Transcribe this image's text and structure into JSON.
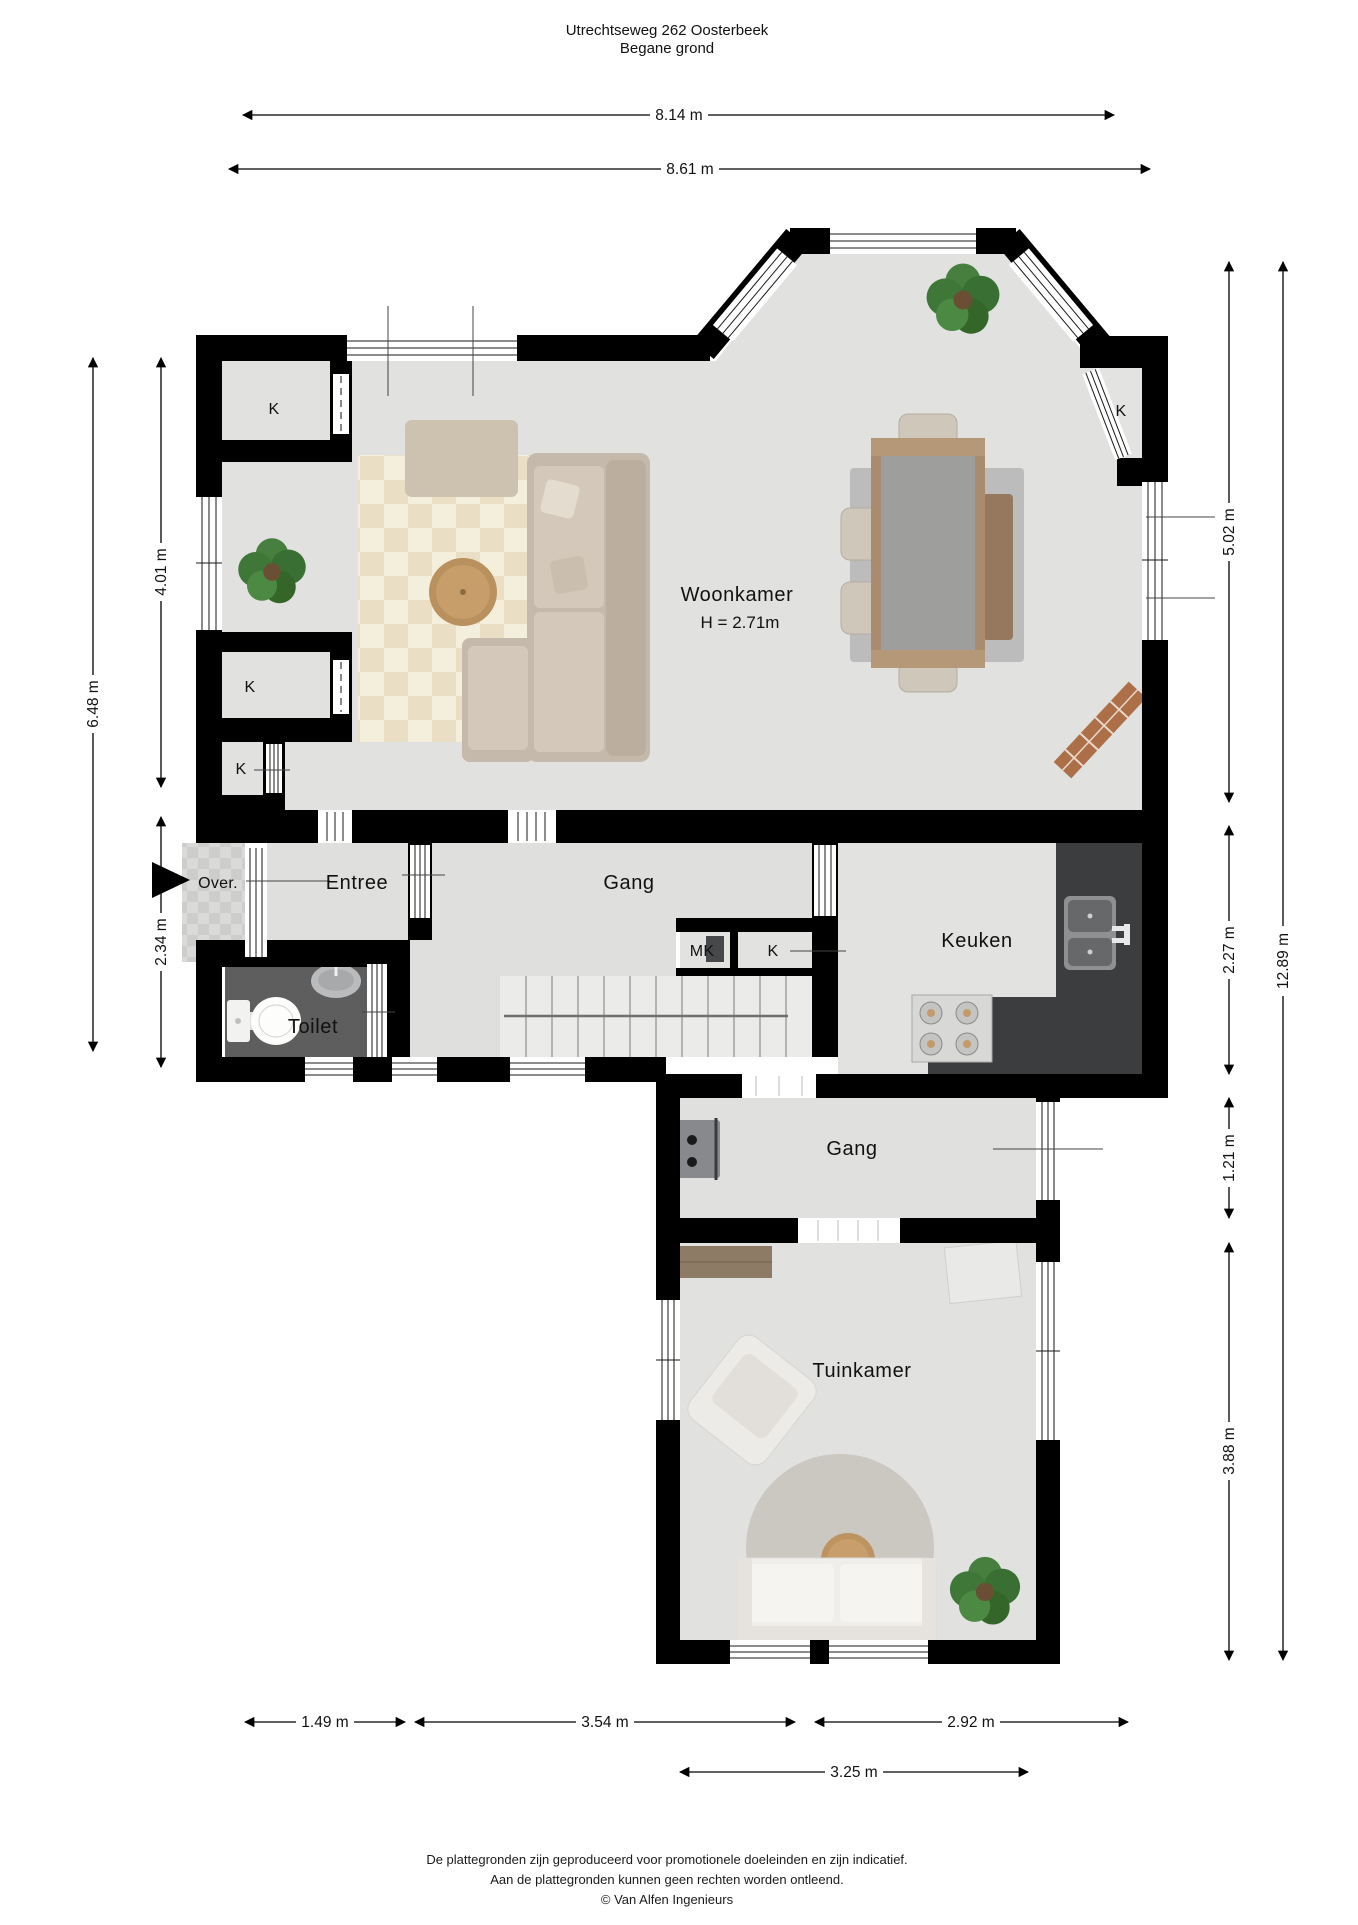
{
  "title": {
    "line1": "Utrechtseweg 262 Oosterbeek",
    "line2": "Begane grond"
  },
  "rooms": {
    "woonkamer": {
      "label": "Woonkamer",
      "height": "H = 2.71m"
    },
    "entree": {
      "label": "Entree"
    },
    "gang_boven": {
      "label": "Gang"
    },
    "gang_beneden": {
      "label": "Gang"
    },
    "keuken": {
      "label": "Keuken"
    },
    "toilet": {
      "label": "Toilet"
    },
    "tuinkamer": {
      "label": "Tuinkamer"
    },
    "overloop": {
      "label": "Over."
    },
    "meterkast": {
      "label": "MK"
    },
    "kast": {
      "label": "K"
    }
  },
  "dimensions": {
    "top": [
      {
        "value": "8.14 m"
      },
      {
        "value": "8.61 m"
      }
    ],
    "left": [
      {
        "value": "4.01 m"
      },
      {
        "value": "6.48 m"
      },
      {
        "value": "2.34 m"
      }
    ],
    "right": [
      {
        "value": "5.02 m"
      },
      {
        "value": "2.27 m"
      },
      {
        "value": "1.21 m"
      },
      {
        "value": "3.88 m"
      },
      {
        "value": "12.89 m"
      }
    ],
    "bottom": [
      {
        "value": "1.49 m"
      },
      {
        "value": "3.54 m"
      },
      {
        "value": "2.92 m"
      },
      {
        "value": "3.25 m"
      }
    ]
  },
  "footer": {
    "line1": "De plattegronden zijn geproduceerd voor promotionele doeleinden en zijn indicatief.",
    "line2": "Aan de plattegronden kunnen geen rechten worden ontleend.",
    "line3": "© Van Alfen Ingenieurs"
  },
  "colors": {
    "wall": "#000000",
    "floor": "#e1e1e0",
    "toilet_floor": "#5e5e5e",
    "kitchen_counter": "#3b3d3e",
    "rug_cream": "#eadfc4",
    "rug_gray": "#bcbcbc",
    "wood": "#b8915e",
    "sofa_beige": "#c5b9ab",
    "plant_green": "#3c6e38",
    "porch_tile": "#d8d8d7"
  }
}
